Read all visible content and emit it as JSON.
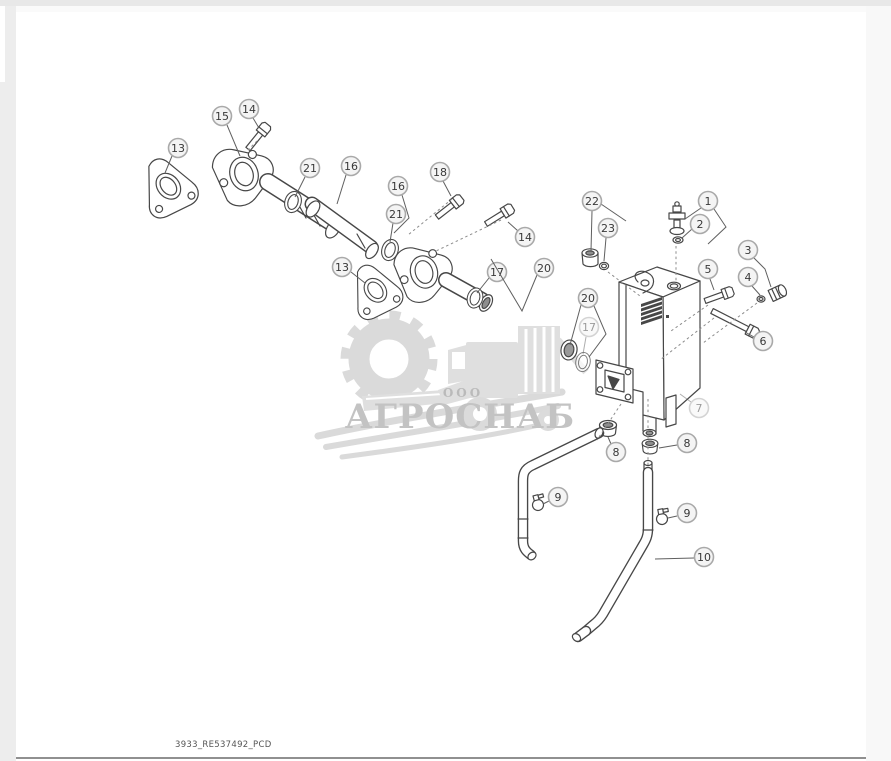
{
  "page": {
    "caption": "3933_RE537492_PCD"
  },
  "watermark": {
    "org_type": "ООО",
    "name": "АГРОСНАБ",
    "icons": [
      "gear-icon",
      "wheat-swoosh-icon",
      "combine-harvester-icon"
    ],
    "gray": "#d6d6d6",
    "text_color": "#bdbdbd"
  },
  "diagram": {
    "description": "Exploded parts drawing: oil reservoir tank, filler tubes, flanges, gaskets, hoses, clamps and fittings",
    "style": {
      "part_stroke": "#474747",
      "circle_fill": "#f4f4f4",
      "circle_stroke": "#a9a9a9",
      "number_color": "#383838",
      "leader_color": "#5f5f5f",
      "dashed_color": "#8c8c8c",
      "circle_radius": 9.5
    },
    "callouts": [
      {
        "label": "1",
        "x": 708,
        "y": 201,
        "leaders": [
          [
            [
              701,
              208
            ],
            [
              685,
              219
            ]
          ],
          [
            [
              714,
              209
            ],
            [
              726,
              227
            ],
            [
              708,
              244
            ]
          ]
        ]
      },
      {
        "label": "2",
        "x": 700,
        "y": 224,
        "leaders": [
          [
            [
              692,
              229
            ],
            [
              682,
              238
            ]
          ]
        ]
      },
      {
        "label": "3",
        "x": 748,
        "y": 250,
        "leaders": [
          [
            [
              754,
              258
            ],
            [
              765,
              269
            ],
            [
              771,
              287
            ]
          ]
        ]
      },
      {
        "label": "4",
        "x": 748,
        "y": 277,
        "leaders": [
          [
            [
              752,
              286
            ],
            [
              760,
              295
            ]
          ]
        ]
      },
      {
        "label": "5",
        "x": 708,
        "y": 269,
        "leaders": [
          [
            [
              710,
              279
            ],
            [
              714,
              290
            ]
          ]
        ]
      },
      {
        "label": "6",
        "x": 763,
        "y": 341,
        "leaders": [
          [
            [
              754,
              337
            ],
            [
              745,
              332
            ]
          ]
        ]
      },
      {
        "label": "7",
        "x": 699,
        "y": 408,
        "faded": true,
        "leaders": [
          [
            [
              691,
              402
            ],
            [
              680,
              394
            ]
          ]
        ]
      },
      {
        "label": "8",
        "x": 616,
        "y": 452,
        "leaders": [
          [
            [
              611,
              444
            ],
            [
              608,
              437
            ]
          ]
        ]
      },
      {
        "label": "8",
        "x": 687,
        "y": 443,
        "leaders": [
          [
            [
              677,
              445
            ],
            [
              659,
              448
            ]
          ]
        ]
      },
      {
        "label": "9",
        "x": 558,
        "y": 497,
        "leaders": [
          [
            [
              549,
              501
            ],
            [
              543,
              504
            ]
          ]
        ]
      },
      {
        "label": "9",
        "x": 687,
        "y": 513,
        "leaders": [
          [
            [
              677,
              516
            ],
            [
              668,
              518
            ]
          ]
        ]
      },
      {
        "label": "10",
        "x": 704,
        "y": 557,
        "leaders": [
          [
            [
              694,
              558
            ],
            [
              655,
              559
            ]
          ]
        ]
      },
      {
        "label": "13",
        "x": 178,
        "y": 148,
        "leaders": [
          [
            [
              172,
              156
            ],
            [
              165,
              173
            ]
          ]
        ]
      },
      {
        "label": "13",
        "x": 342,
        "y": 267,
        "leaders": [
          [
            [
              351,
              272
            ],
            [
              365,
              283
            ]
          ]
        ]
      },
      {
        "label": "14",
        "x": 249,
        "y": 109,
        "leaders": [
          [
            [
              253,
              118
            ],
            [
              259,
              128
            ]
          ]
        ]
      },
      {
        "label": "14",
        "x": 525,
        "y": 237,
        "leaders": [
          [
            [
              518,
              231
            ],
            [
              508,
              222
            ]
          ]
        ]
      },
      {
        "label": "15",
        "x": 222,
        "y": 116,
        "leaders": [
          [
            [
              227,
              125
            ],
            [
              240,
              156
            ]
          ]
        ]
      },
      {
        "label": "16",
        "x": 351,
        "y": 166,
        "leaders": [
          [
            [
              346,
              175
            ],
            [
              337,
              204
            ]
          ]
        ]
      },
      {
        "label": "16",
        "x": 398,
        "y": 186,
        "leaders": [
          [
            [
              402,
              195
            ],
            [
              409,
              218
            ],
            [
              394,
              233
            ]
          ]
        ]
      },
      {
        "label": "17",
        "x": 497,
        "y": 272,
        "leaders": [
          [
            [
              489,
              278
            ],
            [
              477,
              293
            ]
          ]
        ]
      },
      {
        "label": "17",
        "x": 589,
        "y": 327,
        "faded": true,
        "leaders": [
          [
            [
              586,
              337
            ],
            [
              583,
              354
            ]
          ]
        ]
      },
      {
        "label": "18",
        "x": 440,
        "y": 172,
        "leaders": [
          [
            [
              443,
              181
            ],
            [
              451,
              196
            ]
          ]
        ]
      },
      {
        "label": "20",
        "x": 544,
        "y": 268,
        "leaders": [
          [
            [
              537,
              275
            ],
            [
              522,
              311
            ],
            [
              491,
              259
            ]
          ]
        ]
      },
      {
        "label": "20",
        "x": 588,
        "y": 298,
        "leaders": [
          [
            [
              581,
              305
            ],
            [
              570,
              345
            ]
          ],
          [
            [
              594,
              306
            ],
            [
              606,
              334
            ],
            [
              589,
              357
            ]
          ]
        ]
      },
      {
        "label": "21",
        "x": 310,
        "y": 168,
        "leaders": [
          [
            [
              305,
              177
            ],
            [
              295,
              197
            ]
          ]
        ]
      },
      {
        "label": "21",
        "x": 396,
        "y": 214,
        "leaders": [
          [
            [
              393,
              223
            ],
            [
              390,
              242
            ]
          ]
        ]
      },
      {
        "label": "22",
        "x": 592,
        "y": 201,
        "leaders": [
          [
            [
              592,
              211
            ],
            [
              591,
              251
            ]
          ],
          [
            [
              601,
              204
            ],
            [
              626,
              221
            ]
          ]
        ]
      },
      {
        "label": "23",
        "x": 608,
        "y": 228,
        "leaders": [
          [
            [
              606,
              238
            ],
            [
              604,
              261
            ]
          ]
        ]
      }
    ],
    "dashed_links": [
      [
        [
          676,
          246
        ],
        [
          676,
          282
        ]
      ],
      [
        [
          608,
          272
        ],
        [
          640,
          296
        ]
      ],
      [
        [
          708,
          305
        ],
        [
          671,
          331
        ]
      ],
      [
        [
          757,
          303
        ],
        [
          703,
          343
        ]
      ],
      [
        [
          714,
          318
        ],
        [
          660,
          360
        ]
      ],
      [
        [
          648,
          399
        ],
        [
          648,
          465
        ]
      ],
      [
        [
          621,
          404
        ],
        [
          597,
          440
        ]
      ],
      [
        [
          452,
          199
        ],
        [
          408,
          235
        ]
      ],
      [
        [
          501,
          220
        ],
        [
          436,
          251
        ]
      ],
      [
        [
          257,
          141
        ],
        [
          248,
          150
        ]
      ]
    ]
  }
}
